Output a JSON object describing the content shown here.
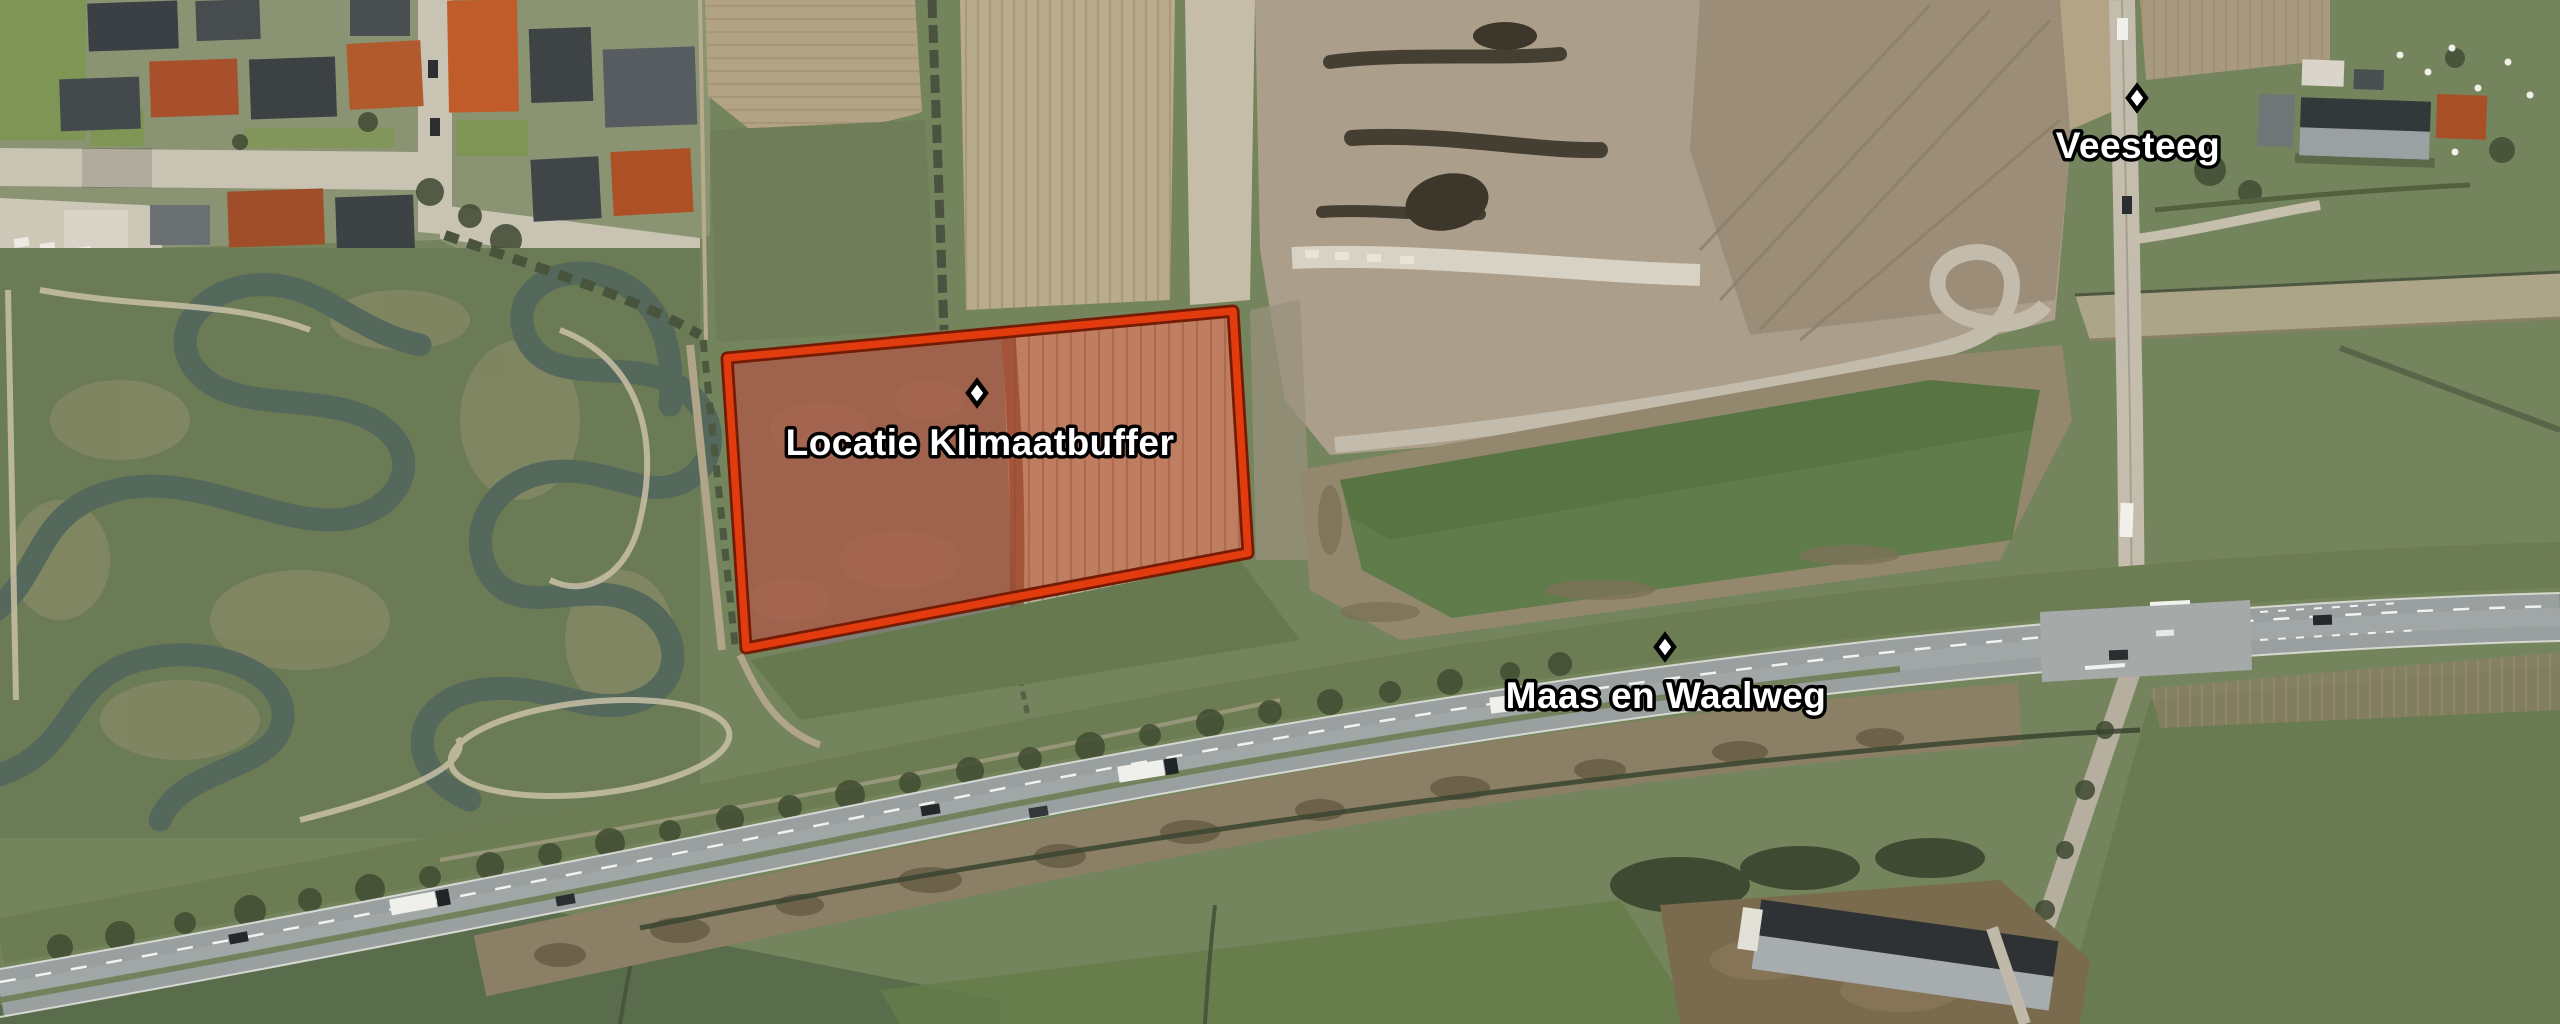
{
  "map": {
    "description": "Aerial photograph with project-location overlay",
    "annotations": [
      {
        "id": "klimaatbuffer",
        "label": "Locatie Klimaatbuffer",
        "marker_icon": "diamond"
      },
      {
        "id": "maas-en-waalweg",
        "label": "Maas en Waalweg",
        "marker_icon": "diamond"
      },
      {
        "id": "veesteeg",
        "label": "Veesteeg",
        "marker_icon": "diamond"
      }
    ],
    "highlight": {
      "name": "Locatie Klimaatbuffer",
      "fill_color": "#cf3c19",
      "border_color": "#e23b0e",
      "border_outline_color": "#731b03"
    },
    "palette": {
      "field_green": "#74845c",
      "bright_field_green": "#5f7c4a",
      "plowed_tan": "#b4a687",
      "excavation_gray": "#ab9e8a",
      "water_channel": "#55685c",
      "highway_asphalt": "#9aa0a0",
      "village_pavement": "#c9c3b4",
      "tree_dark": "#424e33",
      "label_text": "#ffffff",
      "label_outline": "#000000"
    }
  }
}
